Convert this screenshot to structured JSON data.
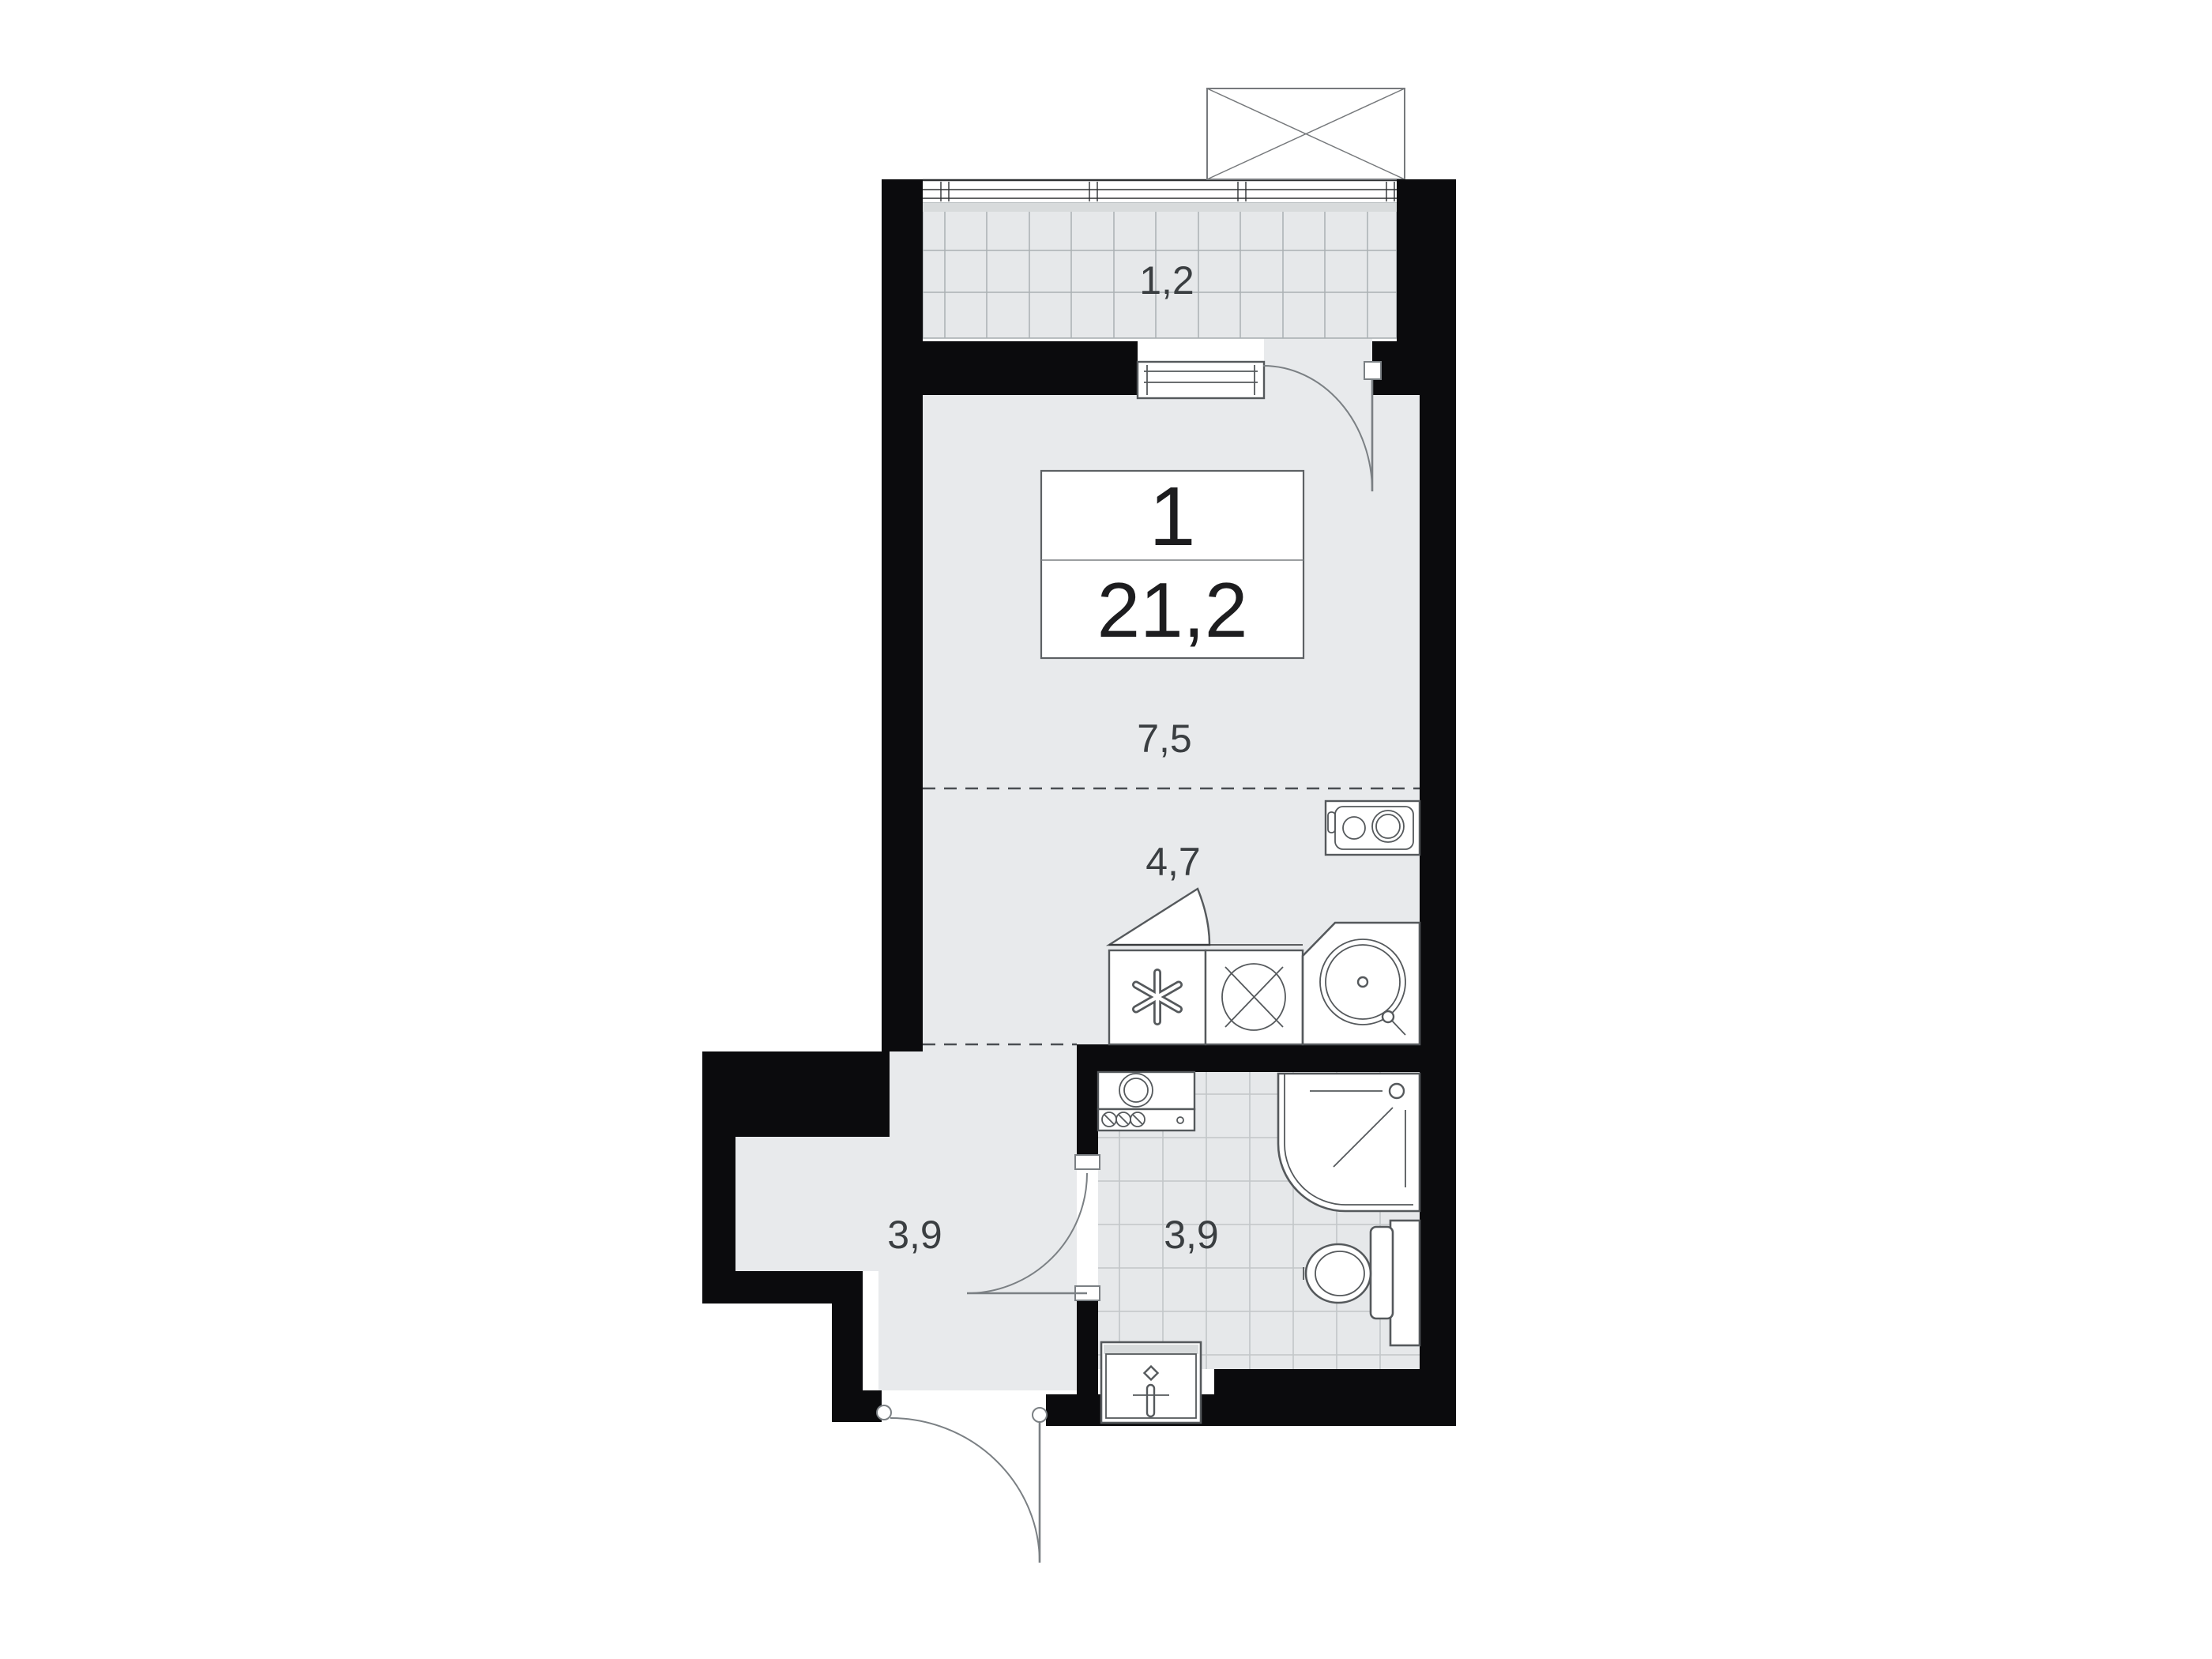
{
  "plan": {
    "unit": {
      "rooms_count": "1",
      "area_total": "21,2"
    },
    "areas": {
      "balcony": "1,2",
      "living_room": "7,5",
      "kitchen": "4,7",
      "hallway": "3,9",
      "bathroom": "3,9"
    }
  },
  "colors": {
    "background": "#ffffff",
    "wall": "#0b0b0d",
    "floor": "#e8eaec",
    "balcony_floor": "#e6e8ea",
    "band": "#d8dbdc",
    "grid_line": "#aab0b3",
    "tile_line": "#c2c6c8",
    "window_line": "#2e3032",
    "outline": "#55595c",
    "outline_light": "#7b8084",
    "dash_line": "#4a4e52",
    "text": "#3a3e41",
    "unit_text": "#1d1d1f"
  }
}
